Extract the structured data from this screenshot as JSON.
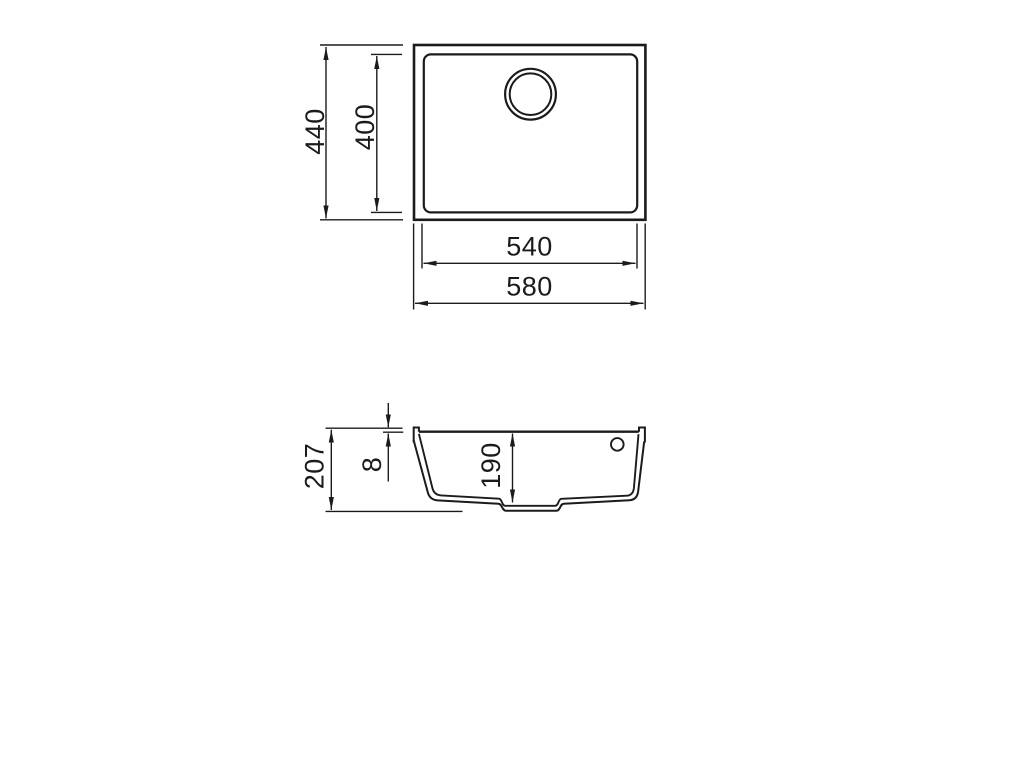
{
  "colors": {
    "line": "#1b1b1b",
    "background": "#ffffff"
  },
  "plan_view": {
    "outer_height": "440",
    "basin_height": "400",
    "basin_width": "540",
    "outer_width": "580"
  },
  "section_view": {
    "overall_depth": "207",
    "rim_height": "8",
    "bowl_depth": "190"
  }
}
